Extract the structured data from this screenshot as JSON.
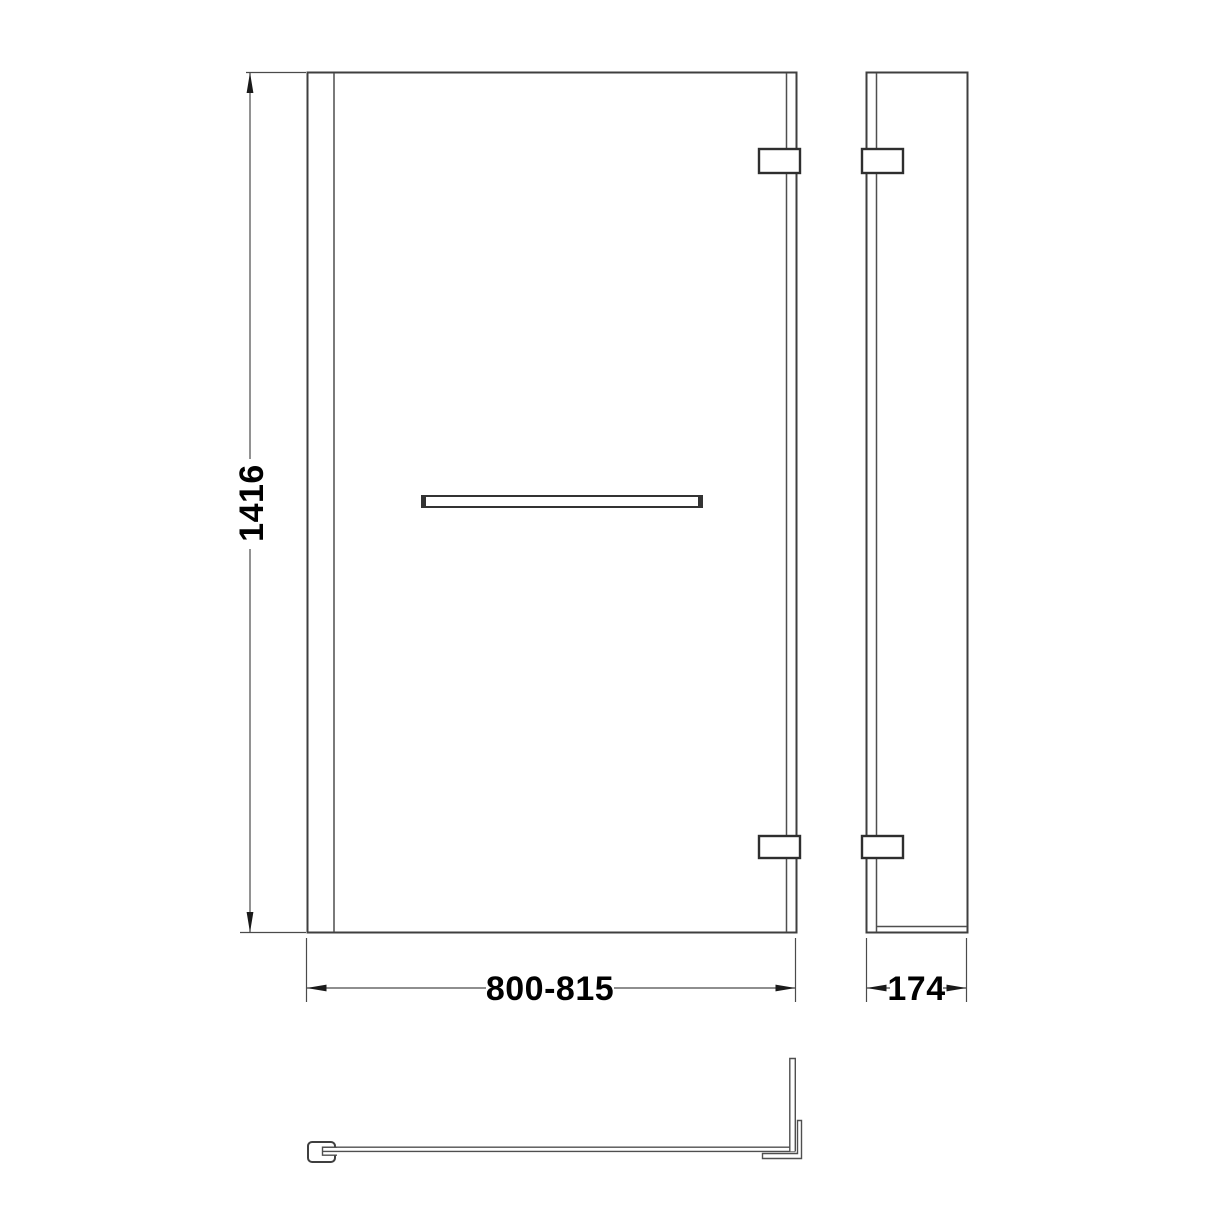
{
  "labels": {
    "height": "1416",
    "width_range": "800-815",
    "depth": "174"
  },
  "dimensions_mm": {
    "height": 1416,
    "width_min": 800,
    "width_max": 815,
    "return_depth": 174
  },
  "drawing": {
    "type": "technical-dimension-drawing",
    "subject": "L-shaped hinged bath screen with towel bar",
    "views": [
      "front-elevation",
      "side-elevation",
      "plan"
    ]
  },
  "colors": {
    "background": "#ffffff",
    "outline": "#3f3f3f",
    "thin_line": "#4f4f4f",
    "bracket": "#2e2e2e",
    "dimension_line": "#4a4a4a",
    "text": "#000000"
  }
}
